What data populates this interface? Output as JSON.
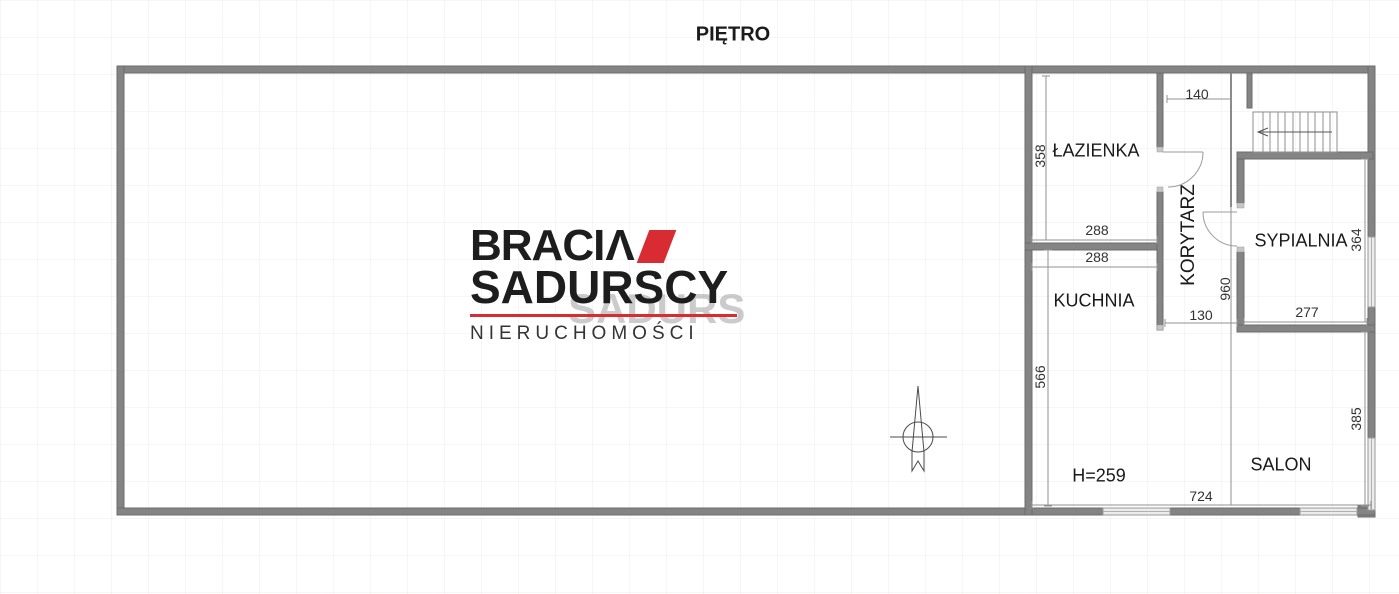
{
  "floor_plan": {
    "title": "PIĘTRO",
    "rooms": {
      "bathroom": "ŁAZIENKA",
      "corridor": "KORYTARZ",
      "bedroom": "SYPIALNIA",
      "kitchen": "KUCHNIA",
      "living_room": "SALON",
      "ceiling_height_note": "H=259"
    },
    "dimensions_cm": {
      "bathroom_depth": "358",
      "bathroom_width": "288",
      "kitchen_width": "288",
      "kitchen_depth": "566",
      "corridor_width": "140",
      "corridor_length": "960",
      "corridor_passage": "130",
      "bedroom_width": "277",
      "bedroom_depth": "364",
      "living_room_width": "724",
      "living_room_depth": "385"
    }
  },
  "watermark": {
    "brand_word1_main": "BRACI",
    "brand_word1_accent_letter": "Λ",
    "brand_word2": "SADURSCY",
    "tagline": "NIERUCHOMOŚCI"
  },
  "colors": {
    "wall_gray": "#848484",
    "logo_red": "#d92b32"
  }
}
